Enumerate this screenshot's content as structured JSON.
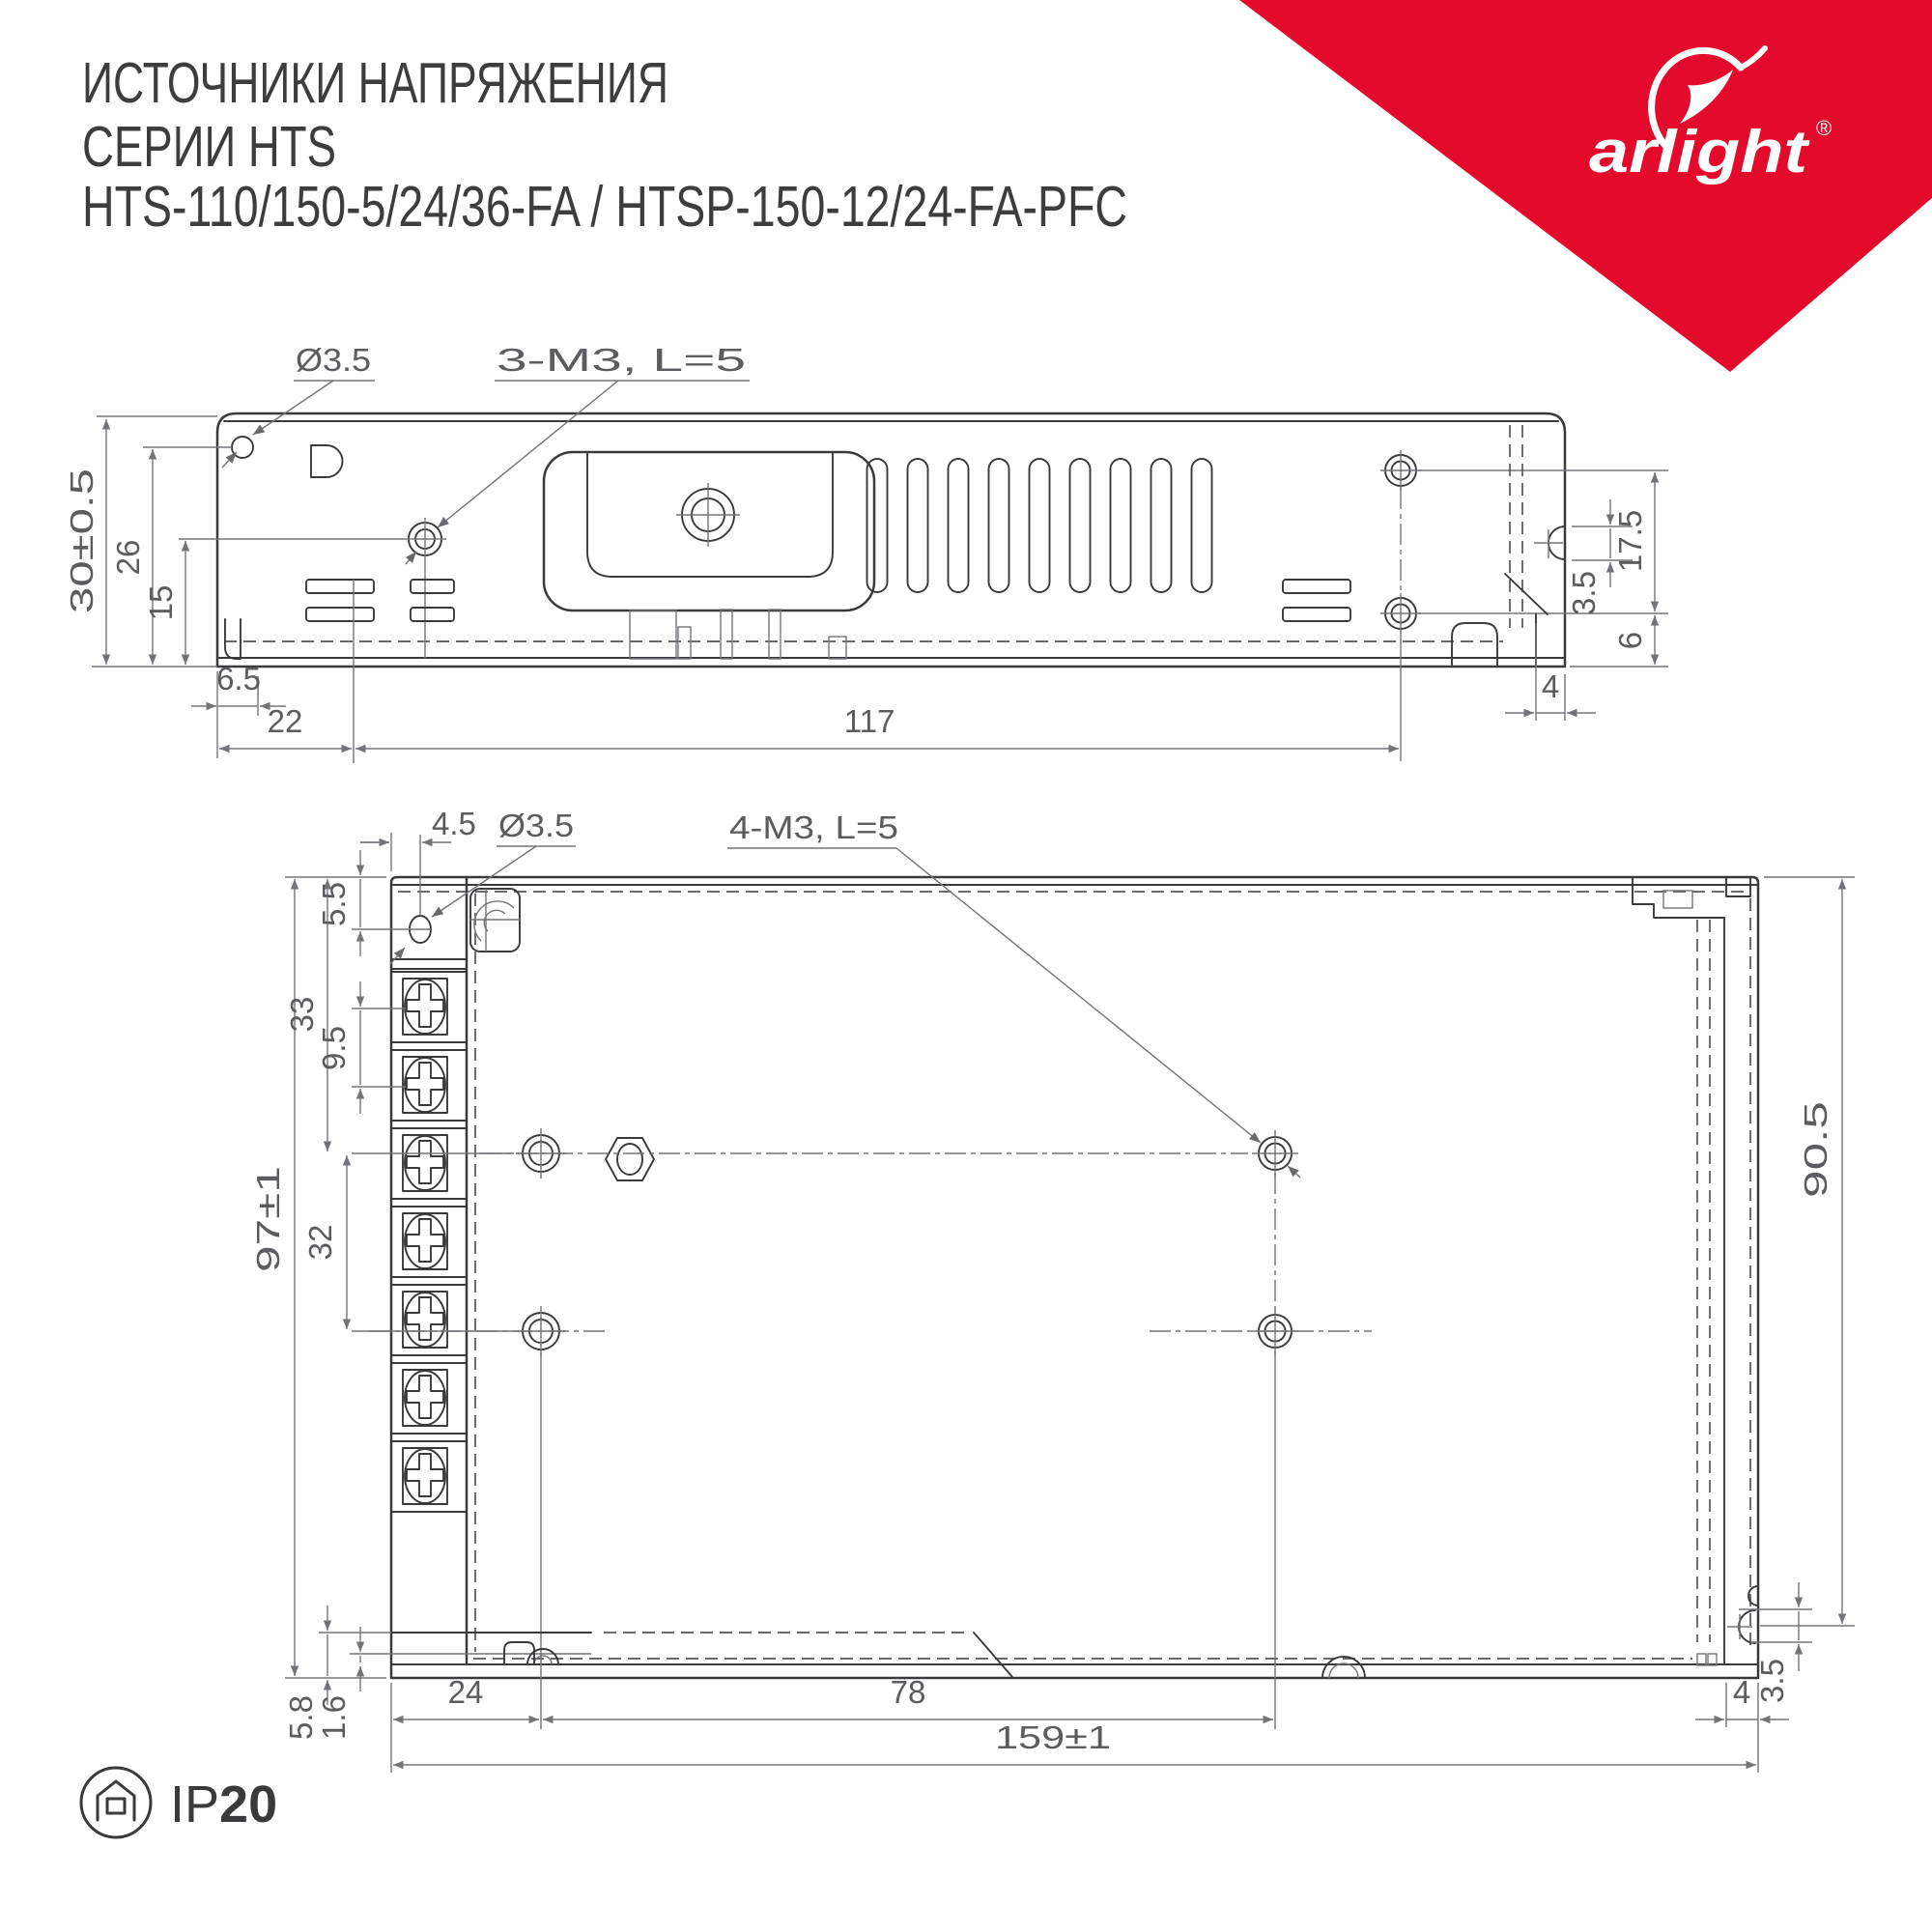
{
  "colors": {
    "accent_red": "#E30A2C",
    "line": "#3A3A3C",
    "dim_gray": "#73737A"
  },
  "header": {
    "line1": "ИСТОЧНИКИ НАПРЯЖЕНИЯ",
    "line2": "СЕРИИ HTS",
    "line3": "HTS-110/150-5/24/36-FA / HTSP-150-12/24-FA-PFC"
  },
  "brand": {
    "wordmark": "arlight",
    "registered": "®"
  },
  "top_view": {
    "label_hole": "Ø3.5",
    "label_screws": "3-M3, L=5",
    "dim_height": "30±0.5",
    "dim_26": "26",
    "dim_15": "15",
    "dim_6_5": "6.5",
    "dim_22": "22",
    "dim_117": "117",
    "dim_17_5": "17.5",
    "dim_3_5": "3.5",
    "dim_6": "6",
    "dim_4": "4"
  },
  "bottom_view": {
    "label_hole": "Ø3.5",
    "label_screws": "4-M3, L=5",
    "dim_4_5": "4.5",
    "dim_5_5": "5.5",
    "dim_33": "33",
    "dim_9_5": "9.5",
    "dim_height": "97±1",
    "dim_32": "32",
    "dim_90_5": "90.5",
    "dim_5_8": "5.8",
    "dim_1_6": "1.6",
    "dim_24": "24",
    "dim_78": "78",
    "dim_width": "159±1",
    "dim_4": "4",
    "dim_3_5": "3.5"
  },
  "footer": {
    "ip_prefix": "IP",
    "ip_value": "20"
  }
}
